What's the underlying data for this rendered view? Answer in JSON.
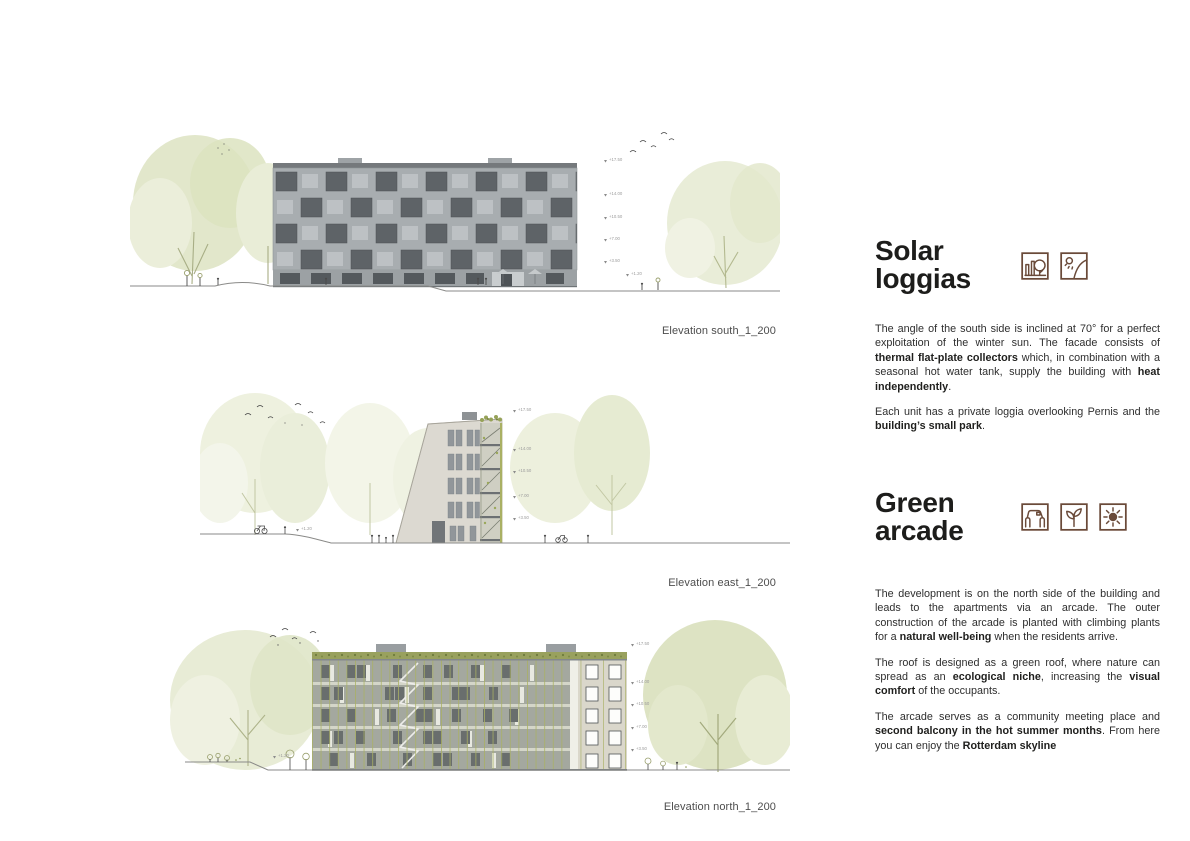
{
  "page_title": "Architecture presentation sheet — elevations",
  "colors": {
    "accent_brown": "#6a4a39",
    "heading_text": "#1d1d1b",
    "body_text": "#2e2e2e",
    "caption_text": "#4d4d4d",
    "tree_green": "#e3e8cd",
    "facade_gray": "#a8adb0",
    "facade_beige": "#dcd9d1",
    "arcade_olive": "#a9b063",
    "green_roof": "#99a15e"
  },
  "elevations": [
    {
      "id": "south",
      "caption": "Elevation south_1_200",
      "level_markers": [
        "+17.50",
        "+14.00",
        "+10.50",
        "+7.00",
        "+3.50"
      ],
      "ground_marker": "+1.20"
    },
    {
      "id": "east",
      "caption": "Elevation east_1_200",
      "level_markers": [
        "+17.50",
        "+14.00",
        "+10.50",
        "+7.00",
        "+3.50"
      ],
      "ground_marker": "+1.20"
    },
    {
      "id": "north",
      "caption": "Elevation north_1_200",
      "level_markers": [
        "+17.50",
        "+14.00",
        "+10.50",
        "+7.00",
        "+3.50"
      ],
      "ground_marker": "+1.20"
    }
  ],
  "sections": [
    {
      "id": "solar-loggias",
      "title_lines": [
        "Solar",
        "loggias"
      ],
      "icon_names": [
        "park-icon",
        "sun-slope-icon"
      ],
      "paragraphs": [
        [
          {
            "t": "The angle of the south side is inclined at 70° for a perfect exploitation of the winter sun. The facade consists of "
          },
          {
            "t": "thermal flat-plate collectors",
            "b": true
          },
          {
            "t": " which, in combination with a seasonal hot water tank, supply the building with "
          },
          {
            "t": "heat independently",
            "b": true
          },
          {
            "t": "."
          }
        ],
        [
          {
            "t": "Each unit has a private loggia overlooking Pernis and the "
          },
          {
            "t": "building’s small park",
            "b": true
          },
          {
            "t": "."
          }
        ]
      ]
    },
    {
      "id": "green-arcade",
      "title_lines": [
        "Green",
        "arcade"
      ],
      "icon_names": [
        "arcade-icon",
        "plant-icon",
        "sun-icon"
      ],
      "paragraphs": [
        [
          {
            "t": "The development is on the north side of the building and leads to the apartments via an arcade. The outer construction of the arcade is planted with climbing plants for a "
          },
          {
            "t": "natural well-being",
            "b": true
          },
          {
            "t": " when the residents arrive."
          }
        ],
        [
          {
            "t": "The roof is designed as a green roof, where nature can spread as an "
          },
          {
            "t": "ecological niche",
            "b": true
          },
          {
            "t": ", increasing the "
          },
          {
            "t": "visual comfort",
            "b": true
          },
          {
            "t": " of the occupants."
          }
        ],
        [
          {
            "t": "The arcade serves as a community meeting place and "
          },
          {
            "t": "second balcony in the hot summer months",
            "b": true
          },
          {
            "t": ". From here you can enjoy the "
          },
          {
            "t": "Rotterdam skyline",
            "b": true
          }
        ]
      ]
    }
  ]
}
